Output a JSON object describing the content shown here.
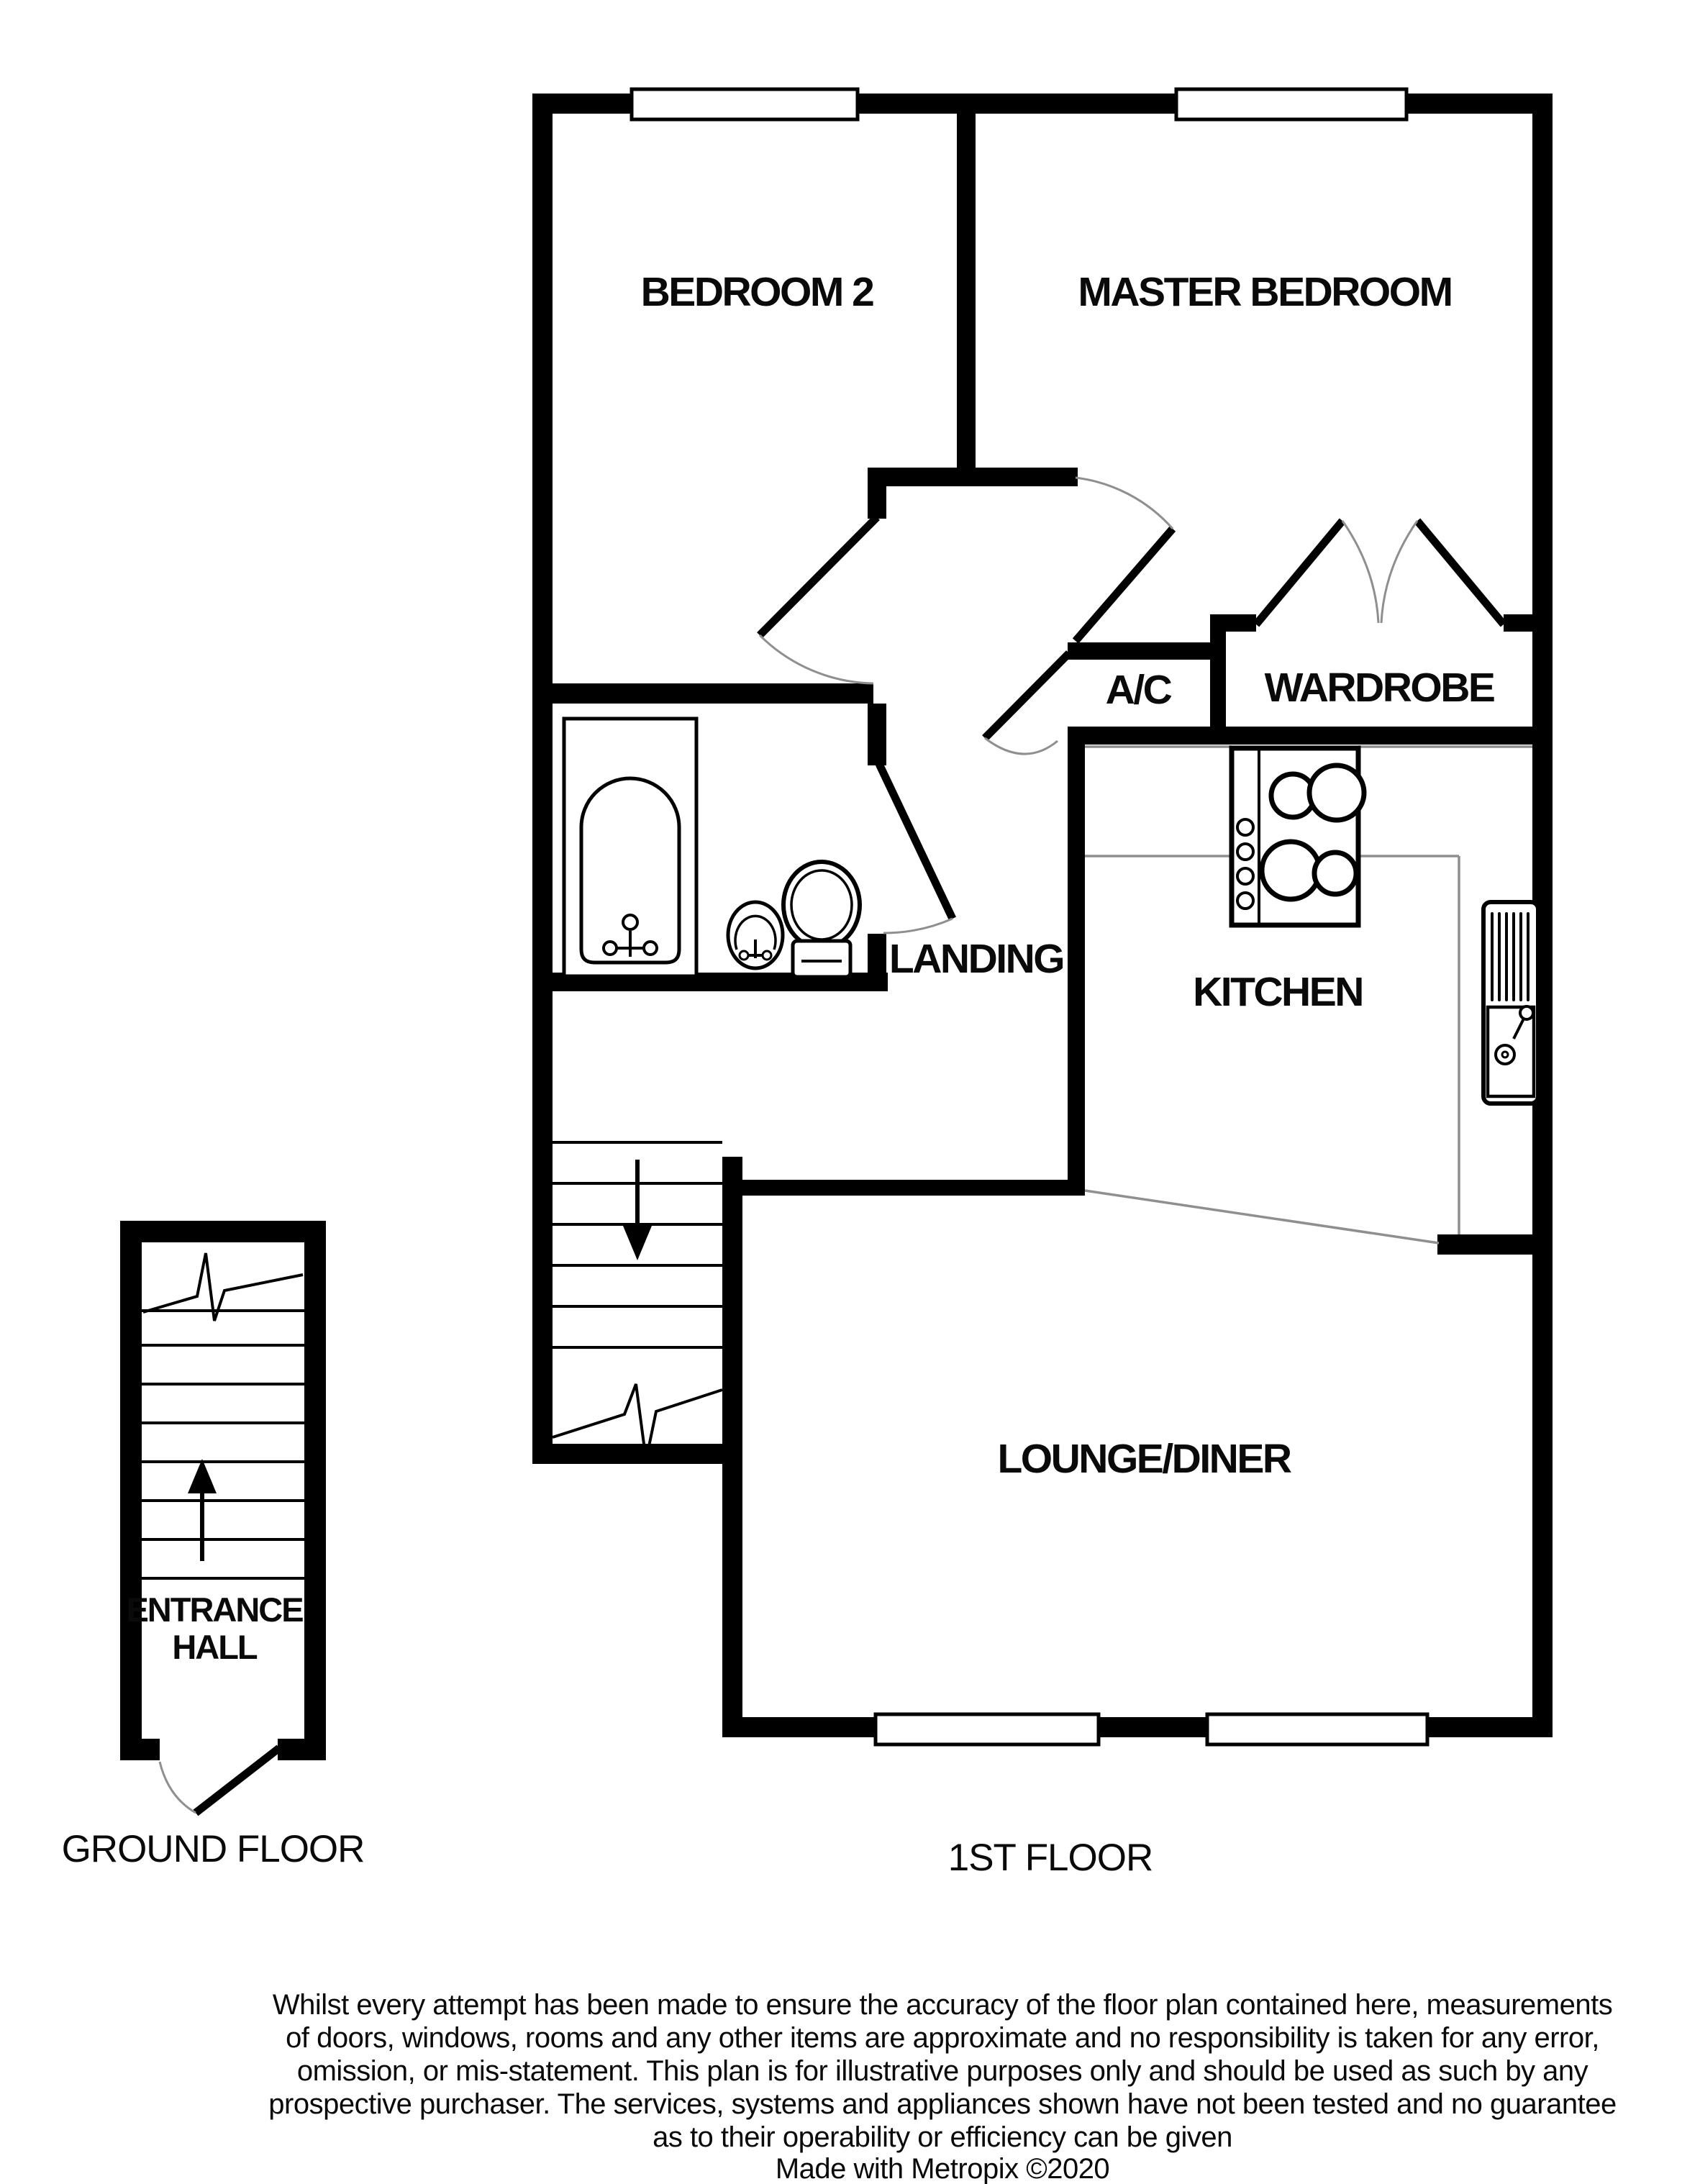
{
  "document": {
    "type": "floor-plan",
    "maker": "Metropix",
    "year_note": "©2020"
  },
  "colors": {
    "wall": "#000000",
    "background": "#ffffff",
    "thin_line": "#8f8f8f",
    "text": "#0a0a0a"
  },
  "floors": {
    "first": {
      "label": "1ST FLOOR",
      "rooms": {
        "bedroom2": "BEDROOM 2",
        "master": "MASTER BEDROOM",
        "ac": "A/C",
        "wardrobe": "WARDROBE",
        "landing": "LANDING",
        "kitchen": "KITCHEN",
        "lounge": "LOUNGE/DINER"
      }
    },
    "ground": {
      "label": "GROUND FLOOR",
      "hall_line1": "ENTRANCE",
      "hall_line2": "HALL"
    }
  },
  "disclaimer": {
    "lines": [
      "Whilst every attempt has been made to ensure the accuracy of the floor plan contained here, measurements",
      "of doors, windows, rooms and any other items are approximate and no responsibility is taken for any error,",
      "omission, or mis-statement. This plan is for illustrative purposes only and should be used as such by any",
      "prospective purchaser. The services, systems and appliances shown have not been tested and no guarantee",
      "as to their operability or efficiency can be given",
      "Made with Metropix ©2020"
    ]
  }
}
